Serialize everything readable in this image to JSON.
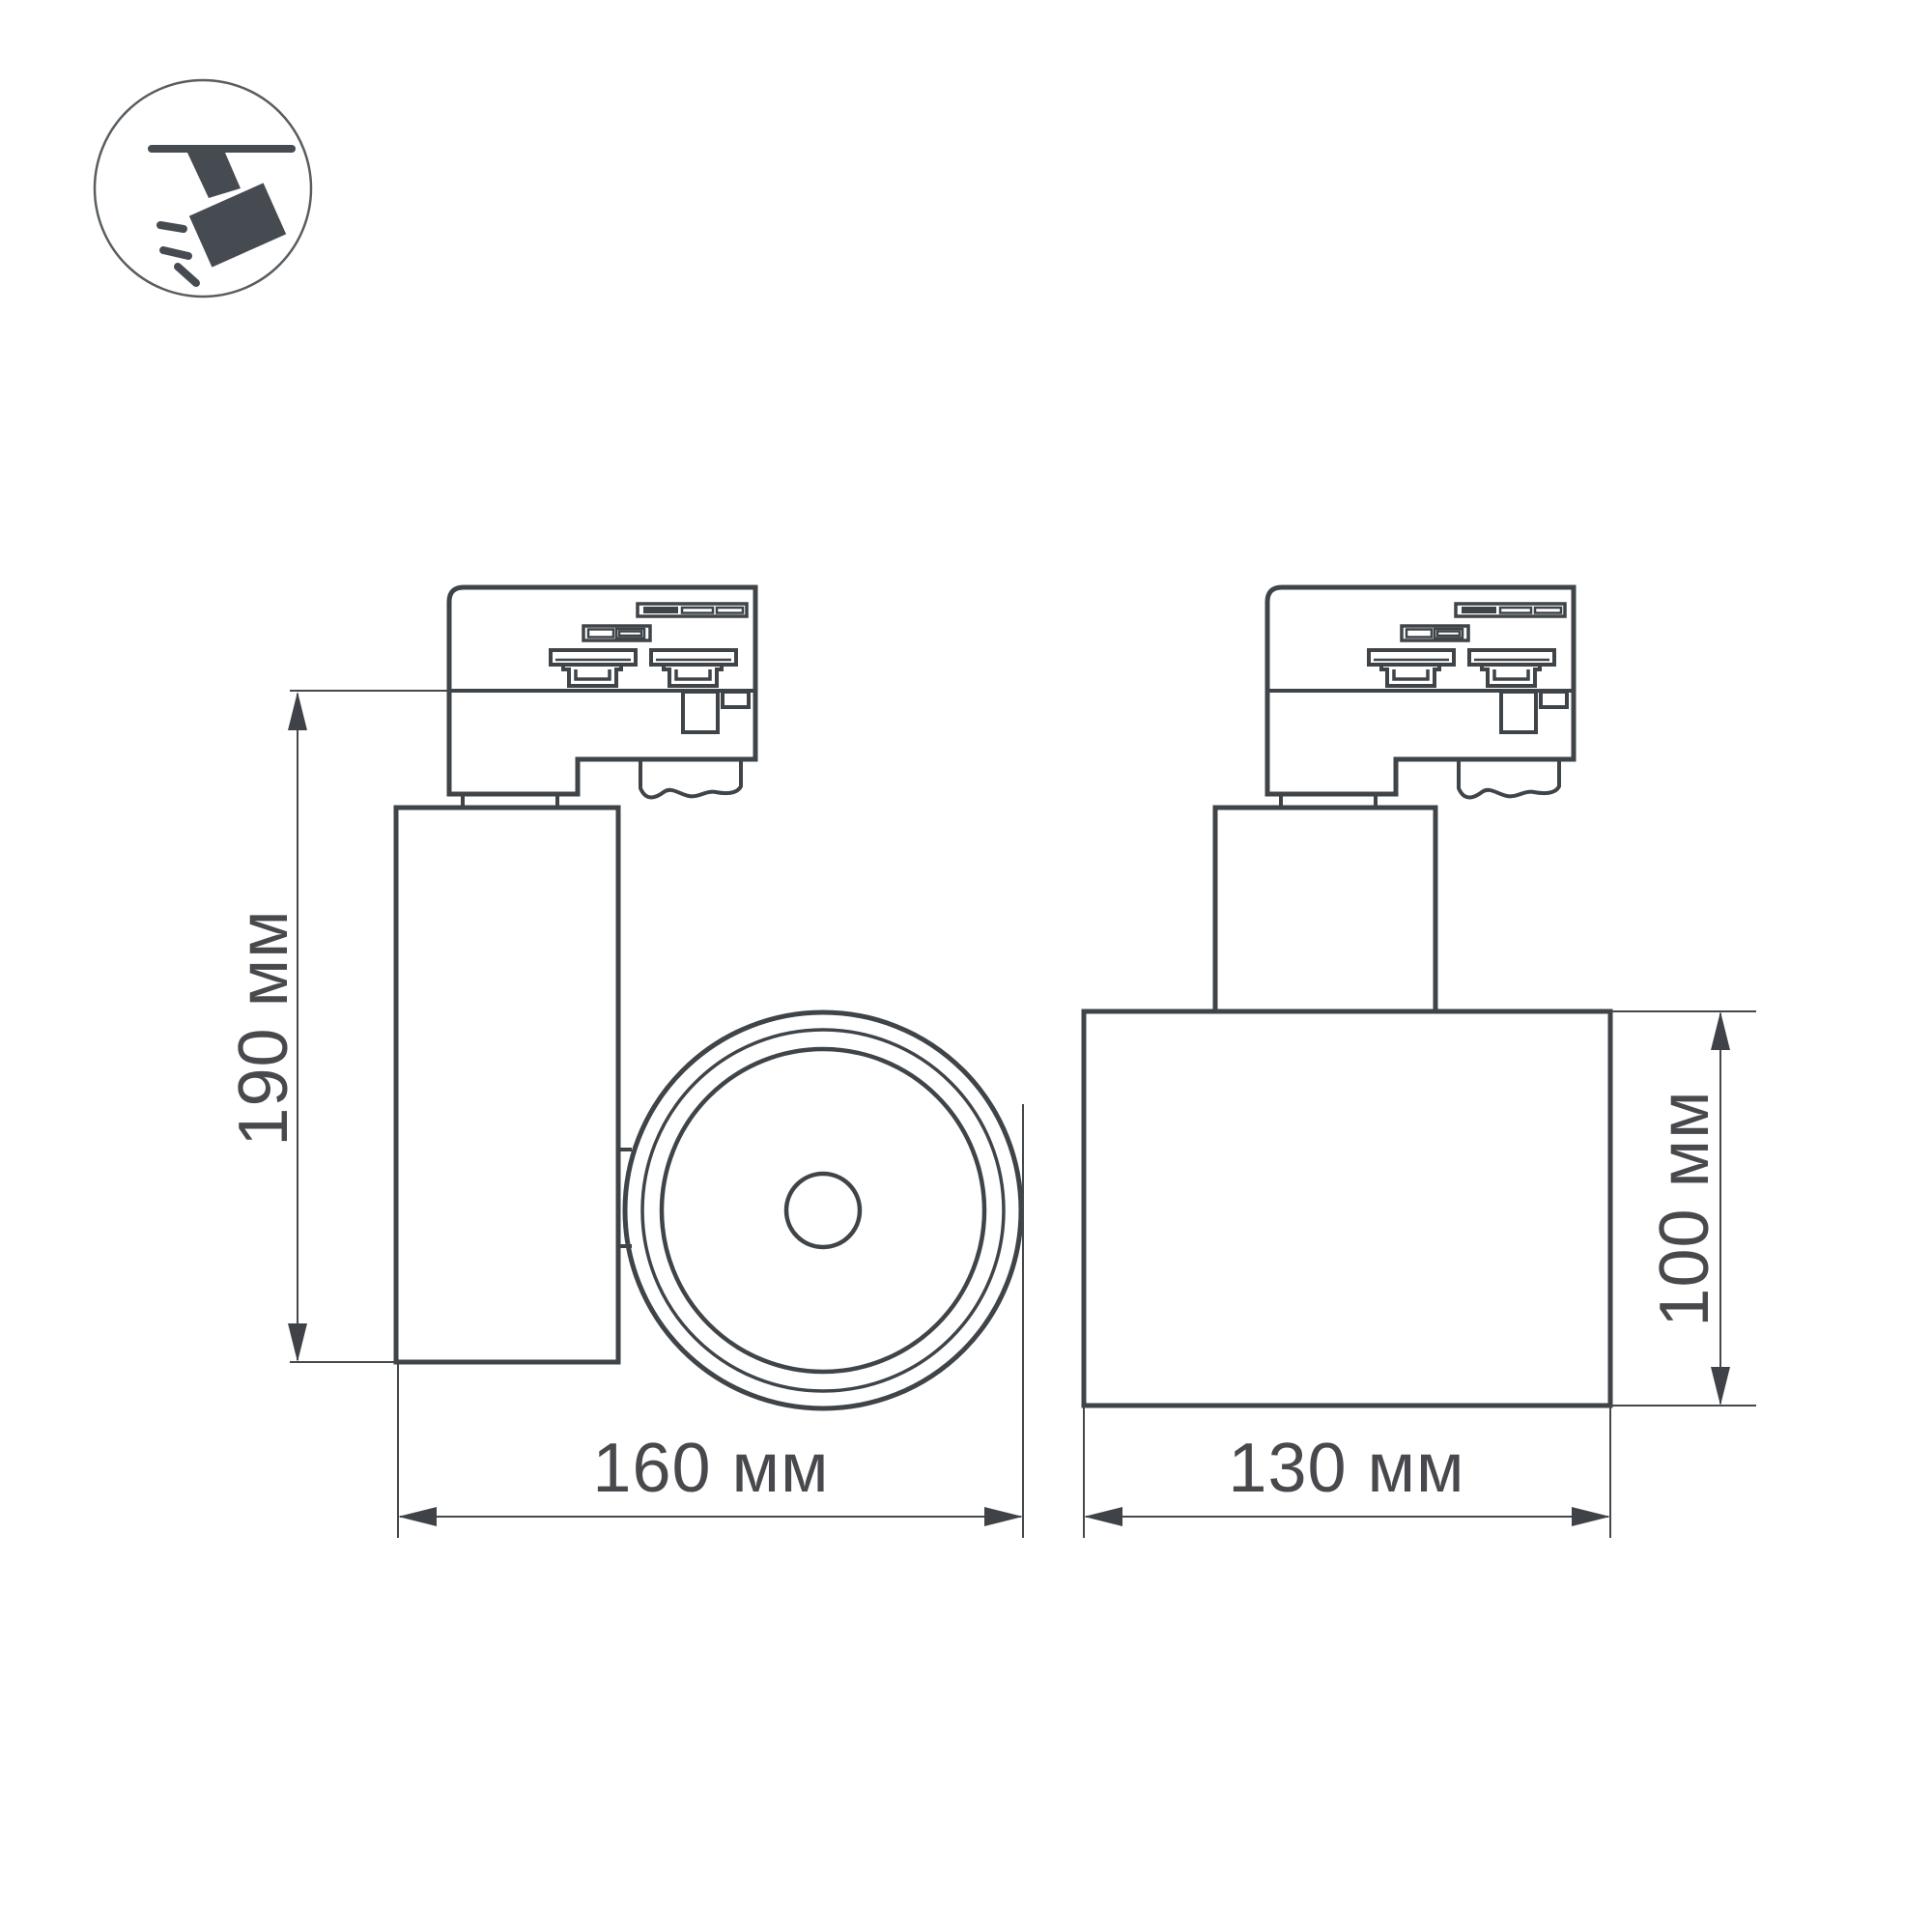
{
  "meta": {
    "title": "Track spotlight dimensional drawing",
    "background": "#ffffff"
  },
  "colors": {
    "line": "#3f4449",
    "dimension_line": "#45484b",
    "text": "#47494c",
    "icon": "#464b51"
  },
  "badge": {
    "icon": "track-spotlight-icon"
  },
  "views": {
    "side": {
      "name": "side-view",
      "height_dim": {
        "label": "190 мм",
        "value_mm": 190,
        "orientation": "vertical"
      },
      "width_dim": {
        "label": "160 мм",
        "value_mm": 160,
        "orientation": "horizontal"
      }
    },
    "front": {
      "name": "front-view",
      "width_dim": {
        "label": "130 мм",
        "value_mm": 130,
        "orientation": "horizontal"
      },
      "height_dim": {
        "label": "100 мм",
        "value_mm": 100,
        "orientation": "vertical"
      }
    }
  }
}
